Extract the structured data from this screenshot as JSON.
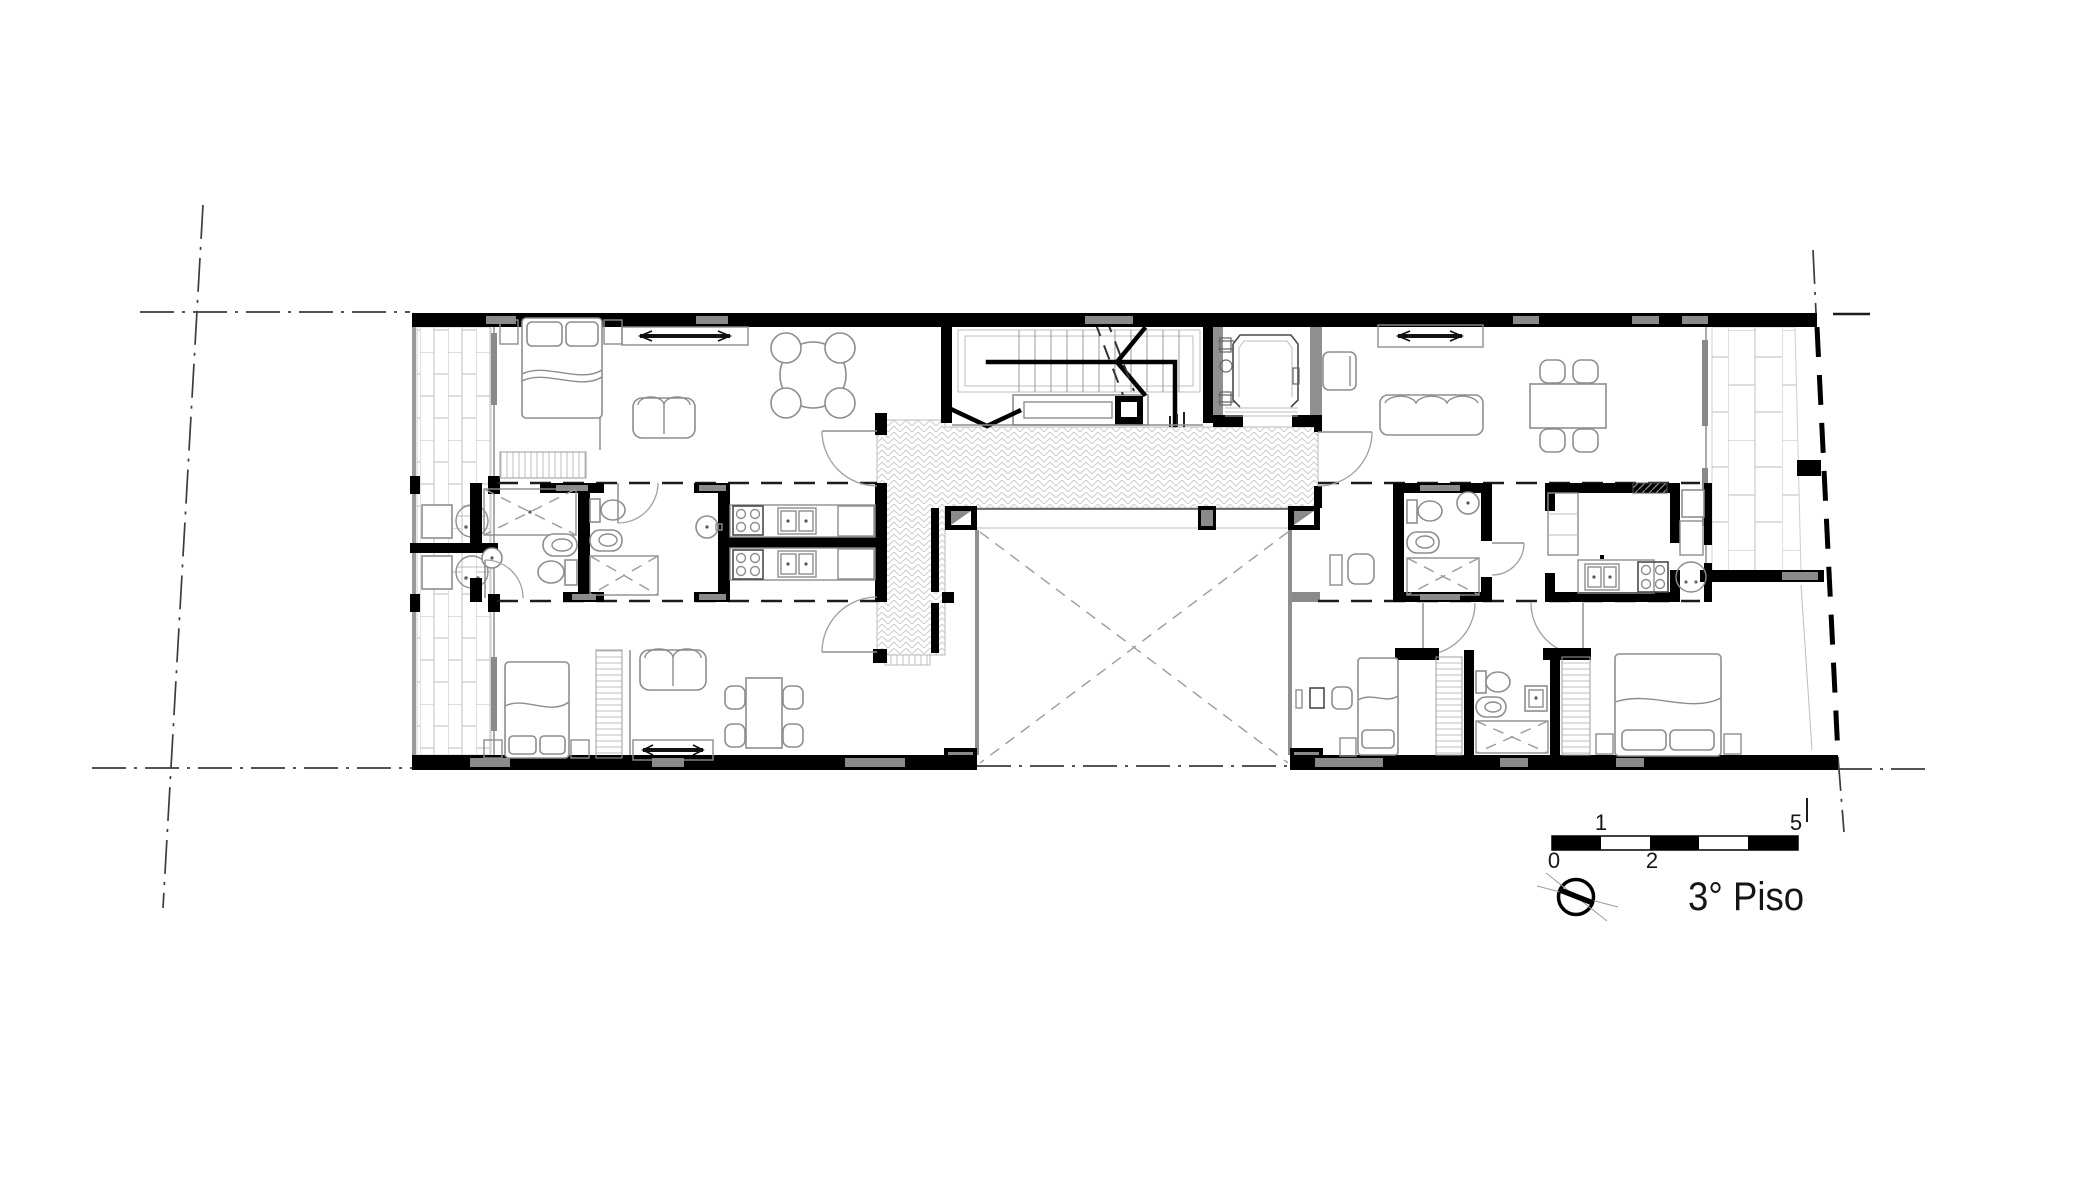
{
  "plan": {
    "floor_label": "3° Piso"
  },
  "scale_bar": {
    "tick_top_left": "1",
    "tick_top_right": "5",
    "tick_bottom_left": "0",
    "tick_bottom_mid": "2"
  },
  "icons": {
    "north": "north-arrow-icon",
    "tv": "tv-symbol",
    "washer": "washing-machine-symbol"
  },
  "colors": {
    "wall": "#000000",
    "window_insert": "#8a8a8a",
    "shaft_wall": "#8f8f8f",
    "line": "#8d8d8d",
    "hatch_line": "#d2d2d2",
    "dash_line": "#3c3c3c",
    "paper": "#ffffff"
  }
}
